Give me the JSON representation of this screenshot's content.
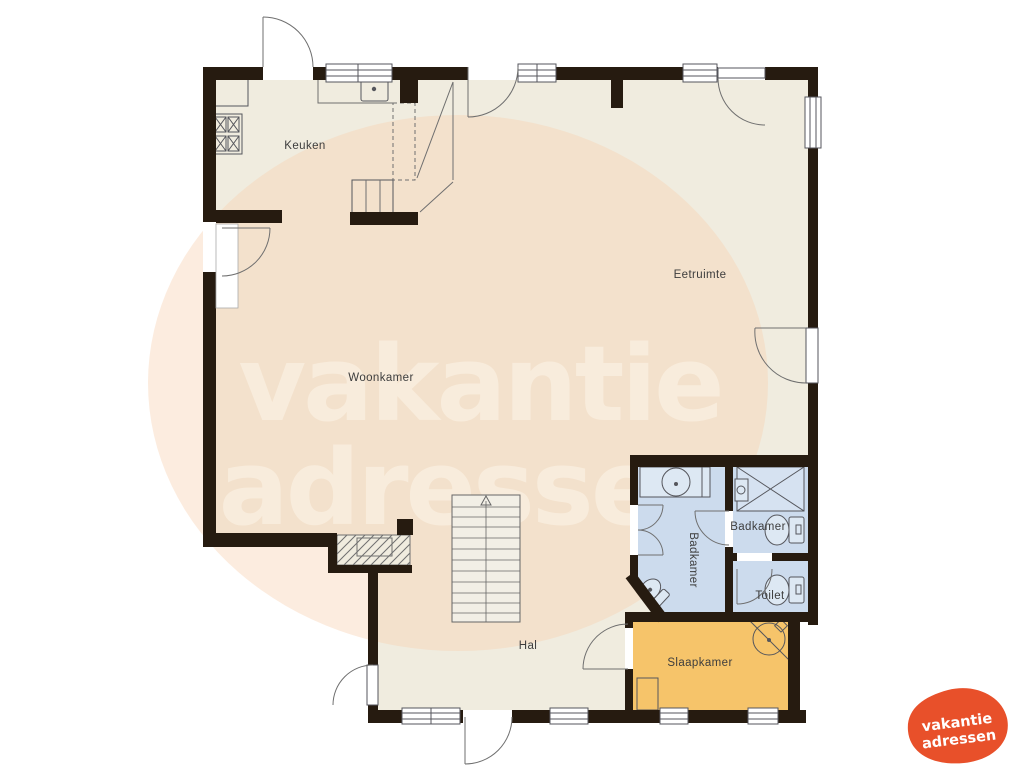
{
  "floorplan": {
    "rooms": {
      "keuken": "Keuken",
      "woonkamer": "Woonkamer",
      "eetruimte": "Eetruimte",
      "hal": "Hal",
      "slaapkamer": "Slaapkamer",
      "badkamer_left": "Badkamer",
      "badkamer_right": "Badkamer",
      "toilet": "Toilet"
    },
    "colors": {
      "wall": "#261b10",
      "floor": "#f0ecdf",
      "bathroom": "#ccdbed",
      "bathroom_fixture": "#dde8f3",
      "bedroom": "#f6c46a",
      "watermark_ellipse": "#f8d2b3",
      "watermark_text": "#fdf6ea",
      "logo_orange": "#e8502a",
      "label_text": "#3d3d3d"
    }
  },
  "watermark": {
    "line1": "vakantie",
    "line2": "adressen"
  },
  "logo": {
    "line1": "vakantie",
    "line2": "adressen"
  }
}
